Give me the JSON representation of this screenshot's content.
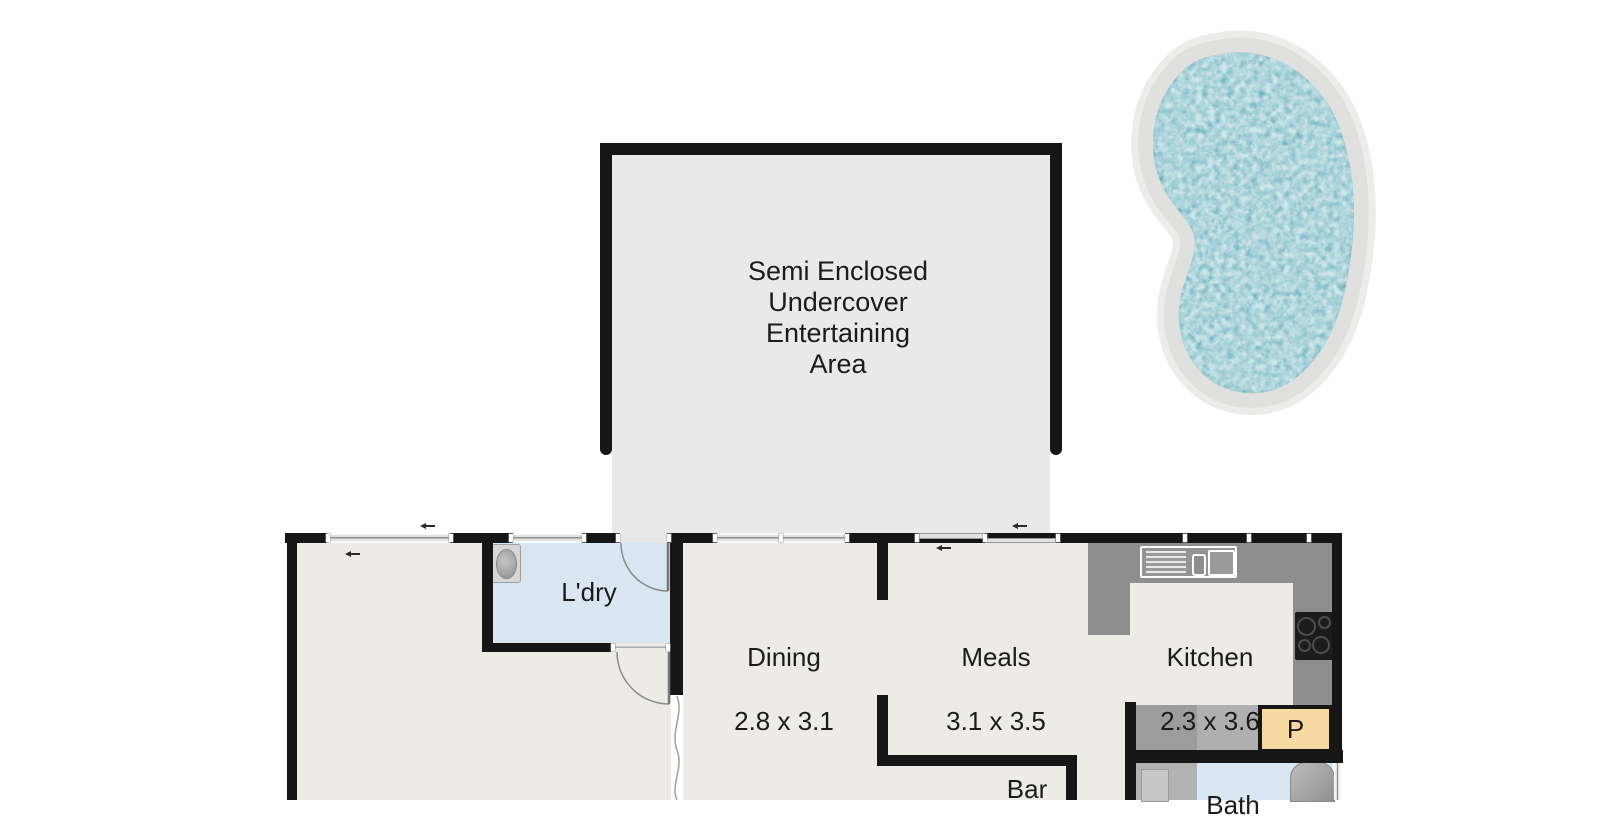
{
  "rooms": {
    "entertaining": {
      "name": "Semi Enclosed\nUndercover\nEntertaining\nArea"
    },
    "laundry": {
      "name": "L'dry"
    },
    "dining": {
      "name": "Dining",
      "dims": "2.8 x 3.1"
    },
    "meals": {
      "name": "Meals",
      "dims": "3.1 x 3.5"
    },
    "kitchen": {
      "name": "Kitchen",
      "dims": "2.3 x 3.6"
    },
    "bar": {
      "name": "Bar"
    },
    "pantry": {
      "name": "P"
    },
    "bath": {
      "name": "Bath"
    }
  },
  "fixtures": {
    "pool": "swimming-pool",
    "laundry_tub": "laundry-tub",
    "kitchen_sink": "kitchen-sink-with-drainer",
    "cooktop": "cooktop-4-burner",
    "shower": "shower",
    "bathtub": "bathtub"
  },
  "colors": {
    "wall": "#161616",
    "house_floor": "#ECEBE5",
    "outdoor_floor": "#E9E9E9",
    "wet_area_floor": "#D9E6F1",
    "counter": "#8E8E8E",
    "pantry_fill": "#F7DAA2",
    "pool_water": "#5FA8B5",
    "pool_surround": "#E0E0DE"
  }
}
